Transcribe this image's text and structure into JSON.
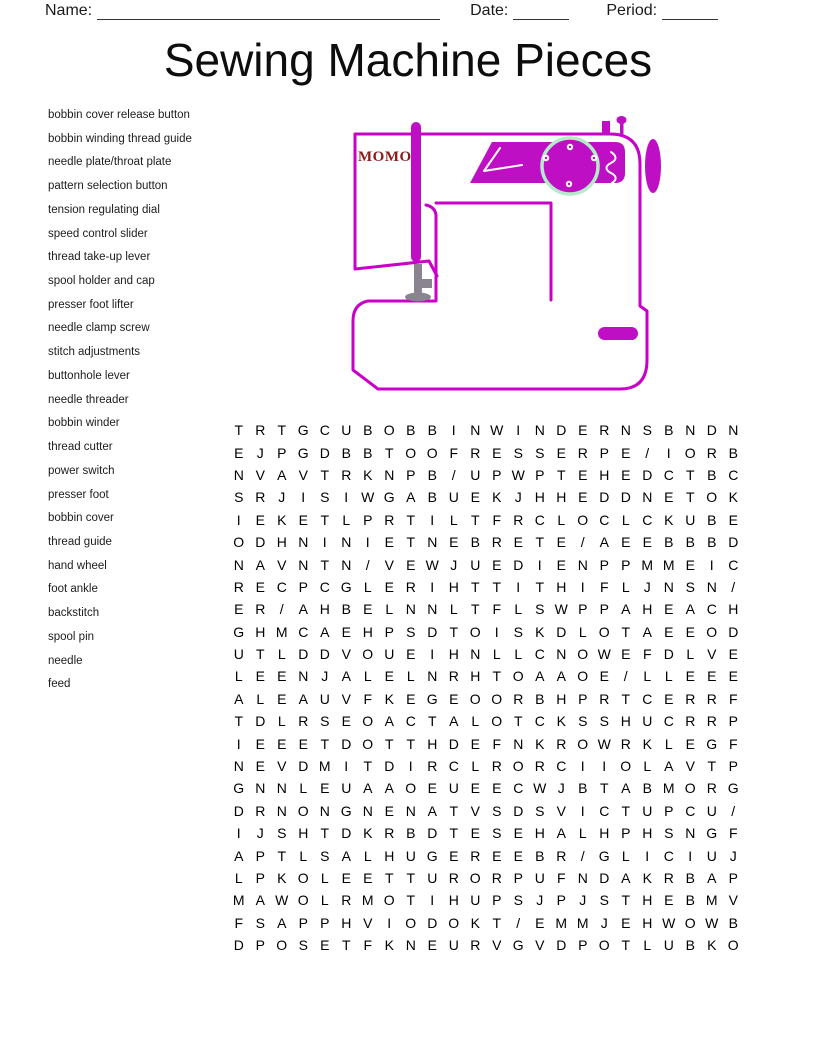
{
  "header": {
    "name_label": "Name:",
    "date_label": "Date:",
    "period_label": "Period:"
  },
  "title": "Sewing Machine Pieces",
  "word_list": [
    "bobbin cover release button",
    "bobbin winding thread guide",
    "needle plate/throat plate",
    "pattern selection button",
    "tension regulating dial",
    "speed control slider",
    "thread take-up lever",
    "spool holder and cap",
    "presser foot lifter",
    "needle clamp screw",
    "stitch adjustments",
    "buttonhole lever",
    "needle threader",
    "bobbin winder",
    "thread cutter",
    "power switch",
    "presser foot",
    "bobbin cover",
    "thread guide",
    "hand wheel",
    "foot ankle",
    "backstitch",
    "spool pin",
    "needle",
    "feed"
  ],
  "machine": {
    "brand": "MOMO"
  },
  "grid": {
    "rows": [
      "TRTGCUBOBBINWINDERNSBNDN",
      "EJPGDBBTOOFRESSERPE/IORB",
      "NVAVTRKNPB/UPWPTEHEDCTBC",
      "SRJISIWGABUEKJHHEDDNETOK",
      "IEKETLPRTILTFRCLOCLCKUBE",
      "ODHNINIETNEBRETE/AEEBBBD",
      "NAVNTN/VEWJUEDIENPPMMEIC",
      "RECPCGLERIHTTITHIFLJNSN/",
      "ER/AHBELNNLTFLSWPPAHEACH",
      "GHMCAEHPSDTOISKDLOTAEEOD",
      "UTLDDVOUEIHNLLCNOWEFDLVE",
      "LEENJALELNRHTOAAOE/LLEEE",
      "ALEAUVFKEGEOORBHPRTCERRF",
      "TDLRSEOACTALOTCKSSHUCRRP",
      "IEEETDOTTHDEFNKROWRKLEGF",
      "NEVDMITDIRCLRORCIIOLAVTP",
      "GNNLEUAAOEUEECWJBTABMORG",
      "DRNONGNENATVSDSVICTUPCU/",
      "IJSHTDKRBDTESEHALHPHSNGF",
      "APTLSALHUGEREEBR/GLICIUJ",
      "LPKOLEETTURORPUFNDAKRBAP",
      "MAWOLRMOTIHUPSJPJSTHEBMV",
      "FSAPPHVIODOKT/EMMJEHWOWB",
      "DPOSETFKNEURVGVDPOTLUBKO"
    ]
  },
  "colors": {
    "machine_outline": "#C800C8",
    "machine_fill": "#BE0FC4",
    "dial_ring": "#B5EBC9",
    "needle_gray": "#8A8490",
    "brand_red": "#8B1A1A"
  }
}
